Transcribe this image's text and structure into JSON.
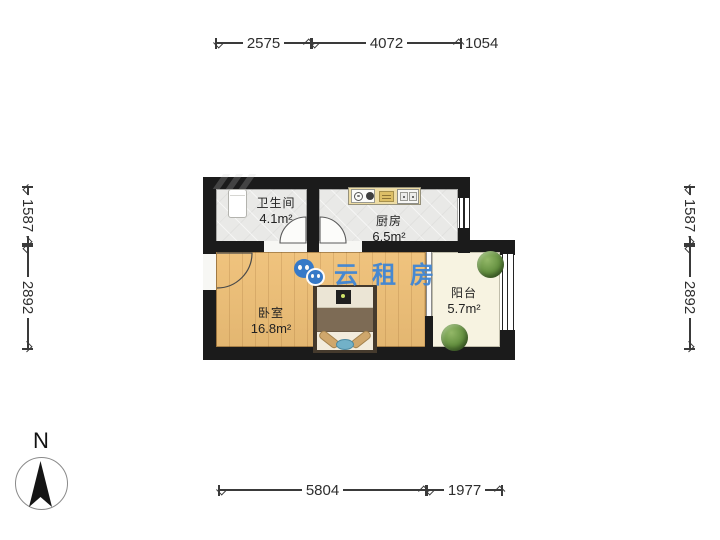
{
  "dimensions": {
    "top": [
      "2575",
      "4072",
      "1054"
    ],
    "bottom": [
      "5804",
      "1977"
    ],
    "left": [
      "1587",
      "2892"
    ],
    "right": [
      "1587",
      "2892"
    ]
  },
  "rooms": {
    "bathroom": {
      "name": "卫生间",
      "area": "4.1m²"
    },
    "kitchen": {
      "name": "厨房",
      "area": "6.5m²"
    },
    "bedroom": {
      "name": "卧室",
      "area": "16.8m²"
    },
    "balcony": {
      "name": "阳台",
      "area": "5.7m²"
    }
  },
  "watermark": {
    "text": "云租房",
    "color": "#3f86d5",
    "icon": "wechat-bubbles-icon"
  },
  "compass": {
    "label": "N"
  },
  "colors": {
    "wall": "#1b1b1b",
    "wood_floor": "#efc077",
    "tile_floor": "#e9e9e7",
    "balcony_floor": "#f7f3e1",
    "watermark_blue": "#3f86d5",
    "dimension_text": "#2e2e2e"
  }
}
